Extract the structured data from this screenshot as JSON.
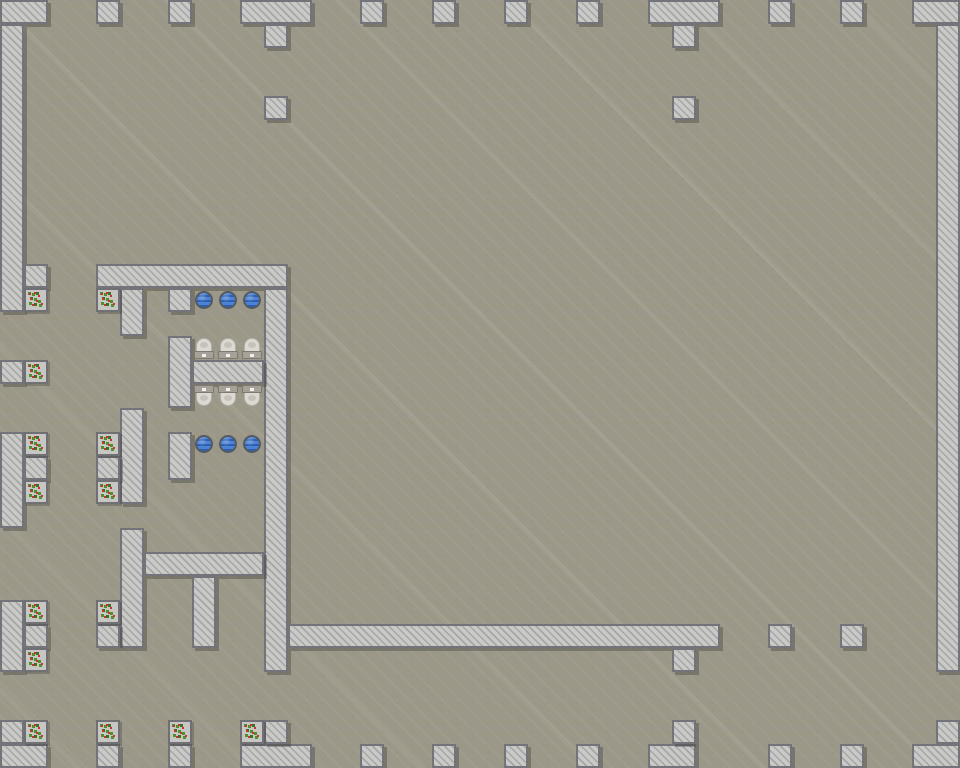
{
  "meta": {
    "scene": "top-down tile map with public restroom building, concrete walls, bushes and plumbing fixtures",
    "grid": {
      "tile_size": 24,
      "cols": 40,
      "rows": 32
    }
  },
  "palette": {
    "floor": "#9b9889",
    "floor_speckle": "rgba(174,150,100,0.30)",
    "wall_fill": "#c9c9c7",
    "wall_hatch": "#a6a6a4",
    "wall_border": "#73737a",
    "wall_shadow": "rgba(55,55,52,0.35)",
    "sink_ring": "#555b61",
    "sink_blue": "#4a82d6",
    "sink_wave": "#2d5dab",
    "toilet_bowl": "#dcd9d3",
    "toilet_bowl_shade": "#c6c2bb",
    "toilet_tank": "#a7a199",
    "toilet_tank_border": "#7e7971",
    "toilet_button": "#f2f0ec",
    "bush_bg": "#c6c6c2",
    "bush_border": "#6f6f74",
    "bush_green": "#4f8f2c",
    "bush_green_dark": "#3c701f",
    "bush_berry": "#c83232"
  },
  "map": {
    "walls": [
      [
        0,
        0,
        2,
        1
      ],
      [
        4,
        0,
        1,
        1
      ],
      [
        7,
        0,
        1,
        1
      ],
      [
        10,
        0,
        3,
        1
      ],
      [
        11,
        1,
        1,
        1
      ],
      [
        15,
        0,
        1,
        1
      ],
      [
        18,
        0,
        1,
        1
      ],
      [
        21,
        0,
        1,
        1
      ],
      [
        24,
        0,
        1,
        1
      ],
      [
        27,
        0,
        3,
        1
      ],
      [
        28,
        1,
        1,
        1
      ],
      [
        32,
        0,
        1,
        1
      ],
      [
        35,
        0,
        1,
        1
      ],
      [
        38,
        0,
        2,
        1
      ],
      [
        0,
        1,
        1,
        12
      ],
      [
        0,
        15,
        1,
        1
      ],
      [
        0,
        18,
        1,
        4
      ],
      [
        0,
        25,
        1,
        3
      ],
      [
        0,
        30,
        1,
        1
      ],
      [
        0,
        31,
        2,
        1
      ],
      [
        1,
        11,
        1,
        1
      ],
      [
        1,
        19,
        1,
        1
      ],
      [
        1,
        26,
        1,
        1
      ],
      [
        39,
        1,
        1,
        27
      ],
      [
        39,
        30,
        1,
        1
      ],
      [
        38,
        31,
        2,
        1
      ],
      [
        11,
        4,
        1,
        1
      ],
      [
        28,
        4,
        1,
        1
      ],
      [
        4,
        11,
        8,
        1
      ],
      [
        5,
        12,
        1,
        2
      ],
      [
        7,
        12,
        1,
        1
      ],
      [
        11,
        12,
        1,
        16
      ],
      [
        7,
        14,
        1,
        3
      ],
      [
        8,
        15,
        3,
        1
      ],
      [
        5,
        17,
        1,
        4
      ],
      [
        4,
        19,
        1,
        1
      ],
      [
        7,
        18,
        1,
        2
      ],
      [
        5,
        22,
        1,
        5
      ],
      [
        6,
        23,
        5,
        1
      ],
      [
        8,
        24,
        1,
        3
      ],
      [
        4,
        26,
        1,
        1
      ],
      [
        12,
        26,
        18,
        1
      ],
      [
        28,
        27,
        1,
        1
      ],
      [
        32,
        26,
        1,
        1
      ],
      [
        35,
        26,
        1,
        1
      ],
      [
        4,
        31,
        1,
        1
      ],
      [
        7,
        31,
        1,
        1
      ],
      [
        10,
        31,
        3,
        1
      ],
      [
        11,
        30,
        1,
        1
      ],
      [
        15,
        31,
        1,
        1
      ],
      [
        18,
        31,
        1,
        1
      ],
      [
        21,
        31,
        1,
        1
      ],
      [
        24,
        31,
        1,
        1
      ],
      [
        27,
        31,
        2,
        1
      ],
      [
        28,
        30,
        1,
        1
      ],
      [
        32,
        31,
        1,
        1
      ],
      [
        35,
        31,
        1,
        1
      ]
    ],
    "sinks": [
      [
        8,
        12
      ],
      [
        9,
        12
      ],
      [
        10,
        12
      ],
      [
        8,
        18
      ],
      [
        9,
        18
      ],
      [
        10,
        18
      ]
    ],
    "toilets": [
      [
        8,
        14,
        "n"
      ],
      [
        9,
        14,
        "n"
      ],
      [
        10,
        14,
        "n"
      ],
      [
        8,
        16,
        "s"
      ],
      [
        9,
        16,
        "s"
      ],
      [
        10,
        16,
        "s"
      ]
    ],
    "bushes": [
      [
        1,
        12
      ],
      [
        4,
        12
      ],
      [
        1,
        15
      ],
      [
        1,
        18
      ],
      [
        4,
        18
      ],
      [
        1,
        20
      ],
      [
        4,
        20
      ],
      [
        1,
        25
      ],
      [
        4,
        25
      ],
      [
        1,
        27
      ],
      [
        1,
        30
      ],
      [
        4,
        30
      ],
      [
        7,
        30
      ],
      [
        10,
        30
      ]
    ]
  }
}
